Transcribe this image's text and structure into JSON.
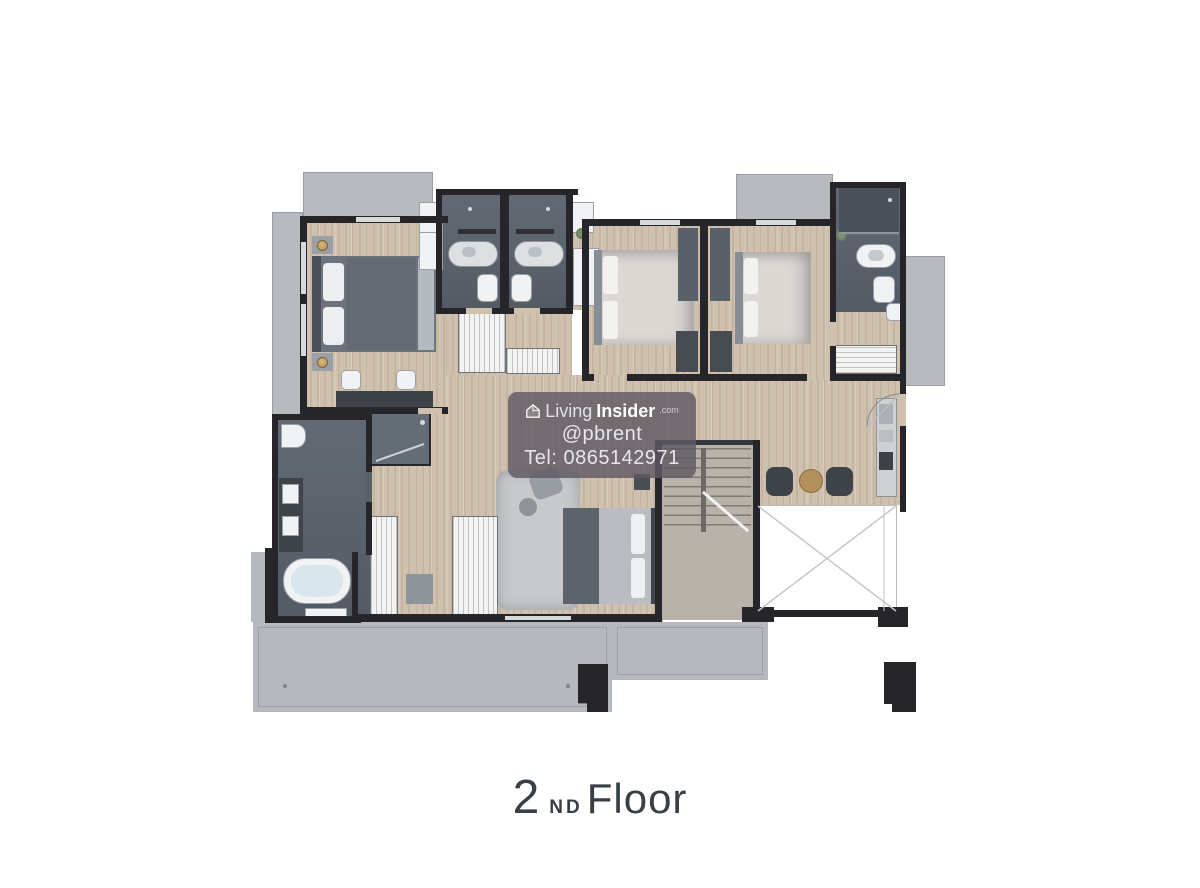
{
  "watermark": {
    "brand_prefix": "Living",
    "brand_suffix": "Insider",
    "brand_tld": ".com",
    "handle": "@pbrent",
    "phone": "Tel: 0865142971"
  },
  "caption": {
    "number": "2",
    "ordinal": "ND",
    "word": "Floor"
  },
  "icons": {
    "watermark_logo": "house-icon"
  },
  "colors": {
    "paper": "#ffffff",
    "wall": "#26262a",
    "wood": "#cfc1ae",
    "tile": "#58606a",
    "tileLight": "#646c76",
    "balcony": "#b7bbc0",
    "terrace": "#b5b9bd",
    "fixture": "#f0f2f3",
    "rug": "#c7c9cb",
    "bedDark": "#6d737c",
    "bedLight": "#dcd9d4",
    "watermarkBg": "rgba(95,89,99,0.82)",
    "watermarkText": "#efedf2",
    "captionText": "#3a3f45",
    "accentBronze": "#b3905c",
    "plant": "#7d8f72"
  }
}
